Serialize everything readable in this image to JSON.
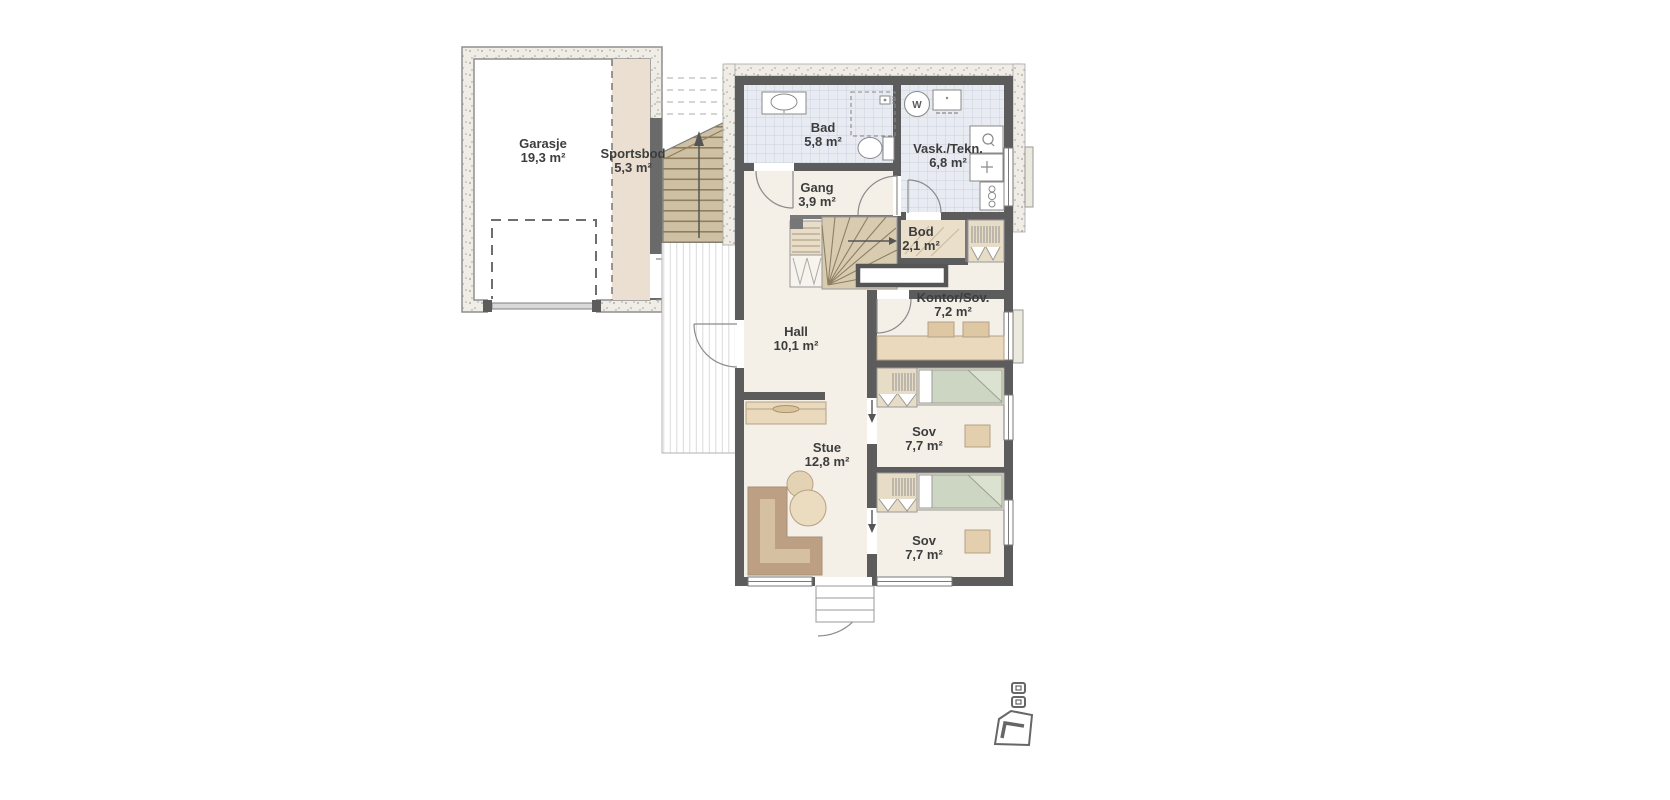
{
  "title": "Floor plan",
  "plan": {
    "rooms": [
      {
        "id": "garasje",
        "name": "Garasje",
        "area": "19,3 m²"
      },
      {
        "id": "sportsbod",
        "name": "Sportsbod",
        "area": "5,3 m²"
      },
      {
        "id": "bad",
        "name": "Bad",
        "area": "5,8 m²"
      },
      {
        "id": "vask_tekn",
        "name": "Vask./Tekn.",
        "area": "6,8 m²"
      },
      {
        "id": "gang",
        "name": "Gang",
        "area": "3,9 m²"
      },
      {
        "id": "bod",
        "name": "Bod",
        "area": "2,1 m²"
      },
      {
        "id": "kontor_sov",
        "name": "Kontor/Sov.",
        "area": "7,2 m²"
      },
      {
        "id": "hall",
        "name": "Hall",
        "area": "10,1 m²"
      },
      {
        "id": "sov_1",
        "name": "Sov",
        "area": "7,7 m²"
      },
      {
        "id": "stue",
        "name": "Stue",
        "area": "12,8 m²"
      },
      {
        "id": "sov_2",
        "name": "Sov",
        "area": "7,7 m²"
      }
    ],
    "symbols": {
      "washing_machine": "W"
    },
    "colors": {
      "wall": "#5c5c5c",
      "room_floor": "#f4f0e8",
      "tile_floor": "#e8ebf2",
      "storage_tan": "#eadfd0",
      "furniture_tan": "#ead9bc",
      "bed_green": "#cdd5c3",
      "stair_wood": "#cec0a3",
      "sofa_brown": "#c7ab8b"
    }
  }
}
